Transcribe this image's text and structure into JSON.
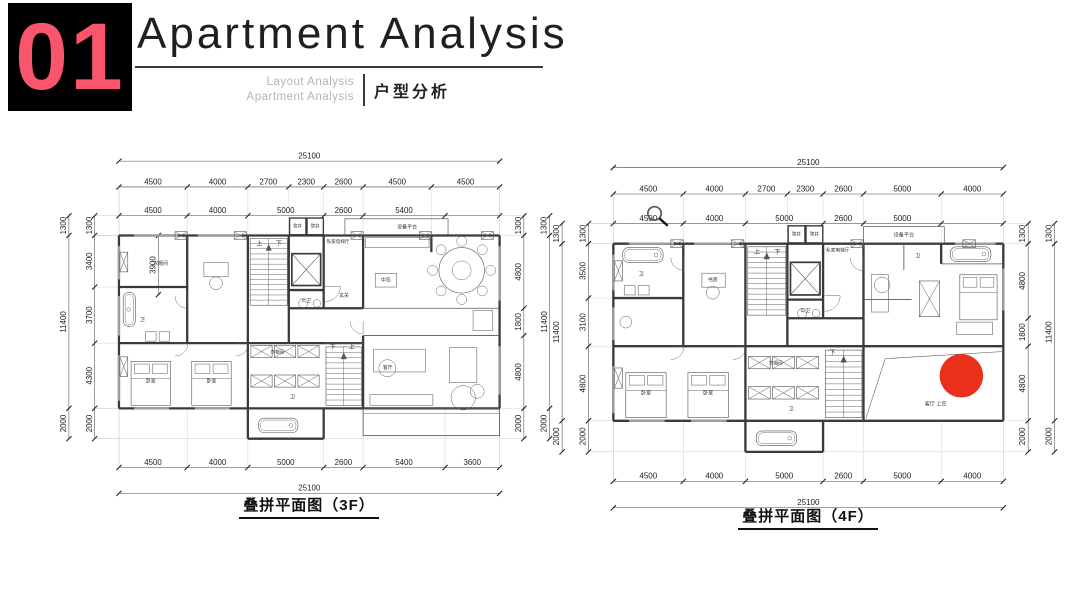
{
  "header": {
    "index": "01",
    "index_color": "#f9566e",
    "index_bg": "#000000",
    "title": "Apartment Analysis",
    "subtitle_line1": "Layout Analysis",
    "subtitle_line2": "Apartment Analysis",
    "subtitle_cn": "户型分析"
  },
  "colors": {
    "wall": "#3a3a3a",
    "thin": "#565656",
    "dim_line": "#444444",
    "dim_text": "#222222",
    "grid": "#bcbcbc",
    "window": "#9e9e9e",
    "label": "#333333",
    "marker_red": "#e8250e"
  },
  "plans": [
    {
      "id": "3F",
      "title": "叠拼平面图（3F）",
      "top_total": "25100",
      "top_segments": [
        4500,
        4000,
        2700,
        2300,
        2600,
        4500,
        4500
      ],
      "bottom_total": "25100",
      "bottom_segments": [
        4500,
        4000,
        5000,
        2600,
        5400,
        3600
      ],
      "left_outer": [
        1300,
        11400,
        2000
      ],
      "left_inner": [
        1300,
        3400,
        3700,
        4300,
        2000
      ],
      "left_extra": {
        "value": "3900",
        "from": 1300,
        "to": 5200,
        "x": 2600
      },
      "right_inner": [
        1300,
        4800,
        1800,
        4800,
        2000
      ],
      "right_outer": [
        1300,
        11400,
        2000
      ],
      "stair_up_label": "上",
      "stair_down_label": "下",
      "rooms": [
        {
          "t": "管井",
          "x": 11780,
          "y": 780,
          "s": 290
        },
        {
          "t": "管井",
          "x": 12940,
          "y": 780,
          "s": 290
        },
        {
          "t": "设备平台",
          "x": 19000,
          "y": 830,
          "s": 330
        },
        {
          "t": "上",
          "x": 9250,
          "y": 1950,
          "s": 400
        },
        {
          "t": "下",
          "x": 10550,
          "y": 1950,
          "s": 400
        },
        {
          "t": "私家电梯厅",
          "x": 14450,
          "y": 1800,
          "s": 300
        },
        {
          "t": "衣帽间",
          "x": 2750,
          "y": 3250,
          "s": 320
        },
        {
          "t": "卫",
          "x": 1550,
          "y": 6950,
          "s": 330
        },
        {
          "t": "公卫",
          "x": 12350,
          "y": 5700,
          "s": 320
        },
        {
          "t": "玄关",
          "x": 14850,
          "y": 5350,
          "s": 320
        },
        {
          "t": "中岛",
          "x": 17600,
          "y": 4350,
          "s": 320
        },
        {
          "t": "客厅",
          "x": 17720,
          "y": 10120,
          "s": 320
        },
        {
          "t": "卧室",
          "x": 2100,
          "y": 11000,
          "s": 320
        },
        {
          "t": "卧室",
          "x": 6100,
          "y": 11000,
          "s": 320
        },
        {
          "t": "衣帽间",
          "x": 10450,
          "y": 9080,
          "s": 300
        },
        {
          "t": "卫",
          "x": 11450,
          "y": 12050,
          "s": 320
        },
        {
          "t": "下",
          "x": 14100,
          "y": 8800,
          "s": 400
        },
        {
          "t": "上",
          "x": 15350,
          "y": 8800,
          "s": 400
        }
      ],
      "marker": null,
      "cursor": null
    },
    {
      "id": "4F",
      "title": "叠拼平面图（4F）",
      "top_total": "25100",
      "top_segments": [
        4500,
        4000,
        2700,
        2300,
        2600,
        5000,
        4000
      ],
      "bottom_total": "25100",
      "bottom_segments": [
        4500,
        4000,
        5000,
        2600,
        5000,
        4000
      ],
      "left_outer": [
        1300,
        11400,
        2000
      ],
      "left_inner": [
        1300,
        3500,
        3100,
        4800,
        2000
      ],
      "left_extra": null,
      "right_inner": [
        1300,
        4800,
        1800,
        4800,
        2000
      ],
      "right_outer": [
        1300,
        11400,
        2000
      ],
      "stair_up_label": "上",
      "stair_down_label": "下",
      "rooms": [
        {
          "t": "管井",
          "x": 11780,
          "y": 780,
          "s": 290
        },
        {
          "t": "管井",
          "x": 12940,
          "y": 780,
          "s": 290
        },
        {
          "t": "设备平台",
          "x": 18700,
          "y": 830,
          "s": 330
        },
        {
          "t": "上",
          "x": 9250,
          "y": 1950,
          "s": 400
        },
        {
          "t": "下",
          "x": 10550,
          "y": 1950,
          "s": 400
        },
        {
          "t": "私家电梯厅",
          "x": 14450,
          "y": 1800,
          "s": 300
        },
        {
          "t": "卫",
          "x": 1800,
          "y": 3350,
          "s": 330
        },
        {
          "t": "书房",
          "x": 6400,
          "y": 3750,
          "s": 320
        },
        {
          "t": "公卫",
          "x": 12350,
          "y": 5700,
          "s": 320
        },
        {
          "t": "卫",
          "x": 19600,
          "y": 2200,
          "s": 330
        },
        {
          "t": "卧室",
          "x": 2100,
          "y": 11000,
          "s": 320
        },
        {
          "t": "卧室",
          "x": 6100,
          "y": 11000,
          "s": 320
        },
        {
          "t": "衣帽间",
          "x": 10450,
          "y": 9080,
          "s": 300
        },
        {
          "t": "卫",
          "x": 11450,
          "y": 12050,
          "s": 320
        },
        {
          "t": "下",
          "x": 14100,
          "y": 8450,
          "s": 400
        },
        {
          "t": "客厅 上空",
          "x": 20750,
          "y": 11720,
          "s": 330
        }
      ],
      "marker": {
        "x": 22400,
        "y": 9800,
        "r": 1400
      },
      "cursor": {
        "x": 2650,
        "y": -650
      }
    }
  ]
}
